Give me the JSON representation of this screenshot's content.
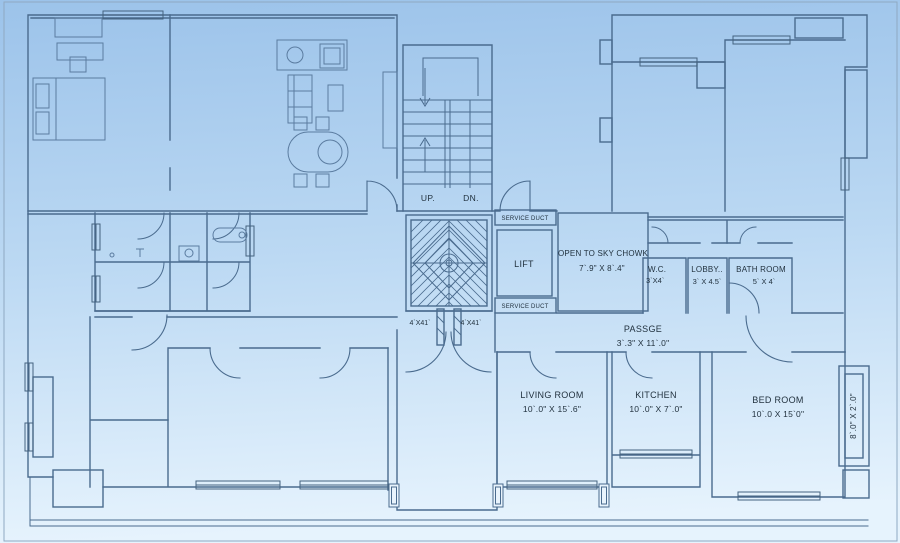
{
  "colors": {
    "background_top": "#9cc3ea",
    "background_mid": "#bcd9f3",
    "background_bottom": "#e6f3fd",
    "wall_line": "#4a6b8e",
    "furniture_line": "#5b7ca0",
    "text": "#22323f"
  },
  "plan": {
    "stair": {
      "up": "UP.",
      "dn": "DN."
    },
    "lift": {
      "label": "LIFT"
    },
    "service_duct_top": "SERVICE DUCT",
    "service_duct_bottom": "SERVICE DUCT",
    "chowk": {
      "name": "OPEN TO SKY CHOWK",
      "dim": "7`.9\" X 8`.4\""
    },
    "wc": {
      "name": "W.C.",
      "dim": "3`X4`"
    },
    "lobby": {
      "name": "LOBBY..",
      "dim": "3` X 4.5`"
    },
    "bath": {
      "name": "BATH ROOM",
      "dim": "5` X 4`"
    },
    "passage": {
      "name": "PASSGE",
      "dim": "3`.3\" X 11`.0\""
    },
    "living": {
      "name": "LIVING ROOM",
      "dim": "10`.0\" X 15`.6\""
    },
    "kitchen": {
      "name": "KITCHEN",
      "dim": "10`.0\" X 7`.0\""
    },
    "bedroom": {
      "name": "BED ROOM",
      "dim": "10`.0 X 15`0\""
    },
    "balcony_right": {
      "dim": "8`.0\" X 2`.0\""
    },
    "duct_left": "4`X41`",
    "duct_right": "4`X41`"
  }
}
